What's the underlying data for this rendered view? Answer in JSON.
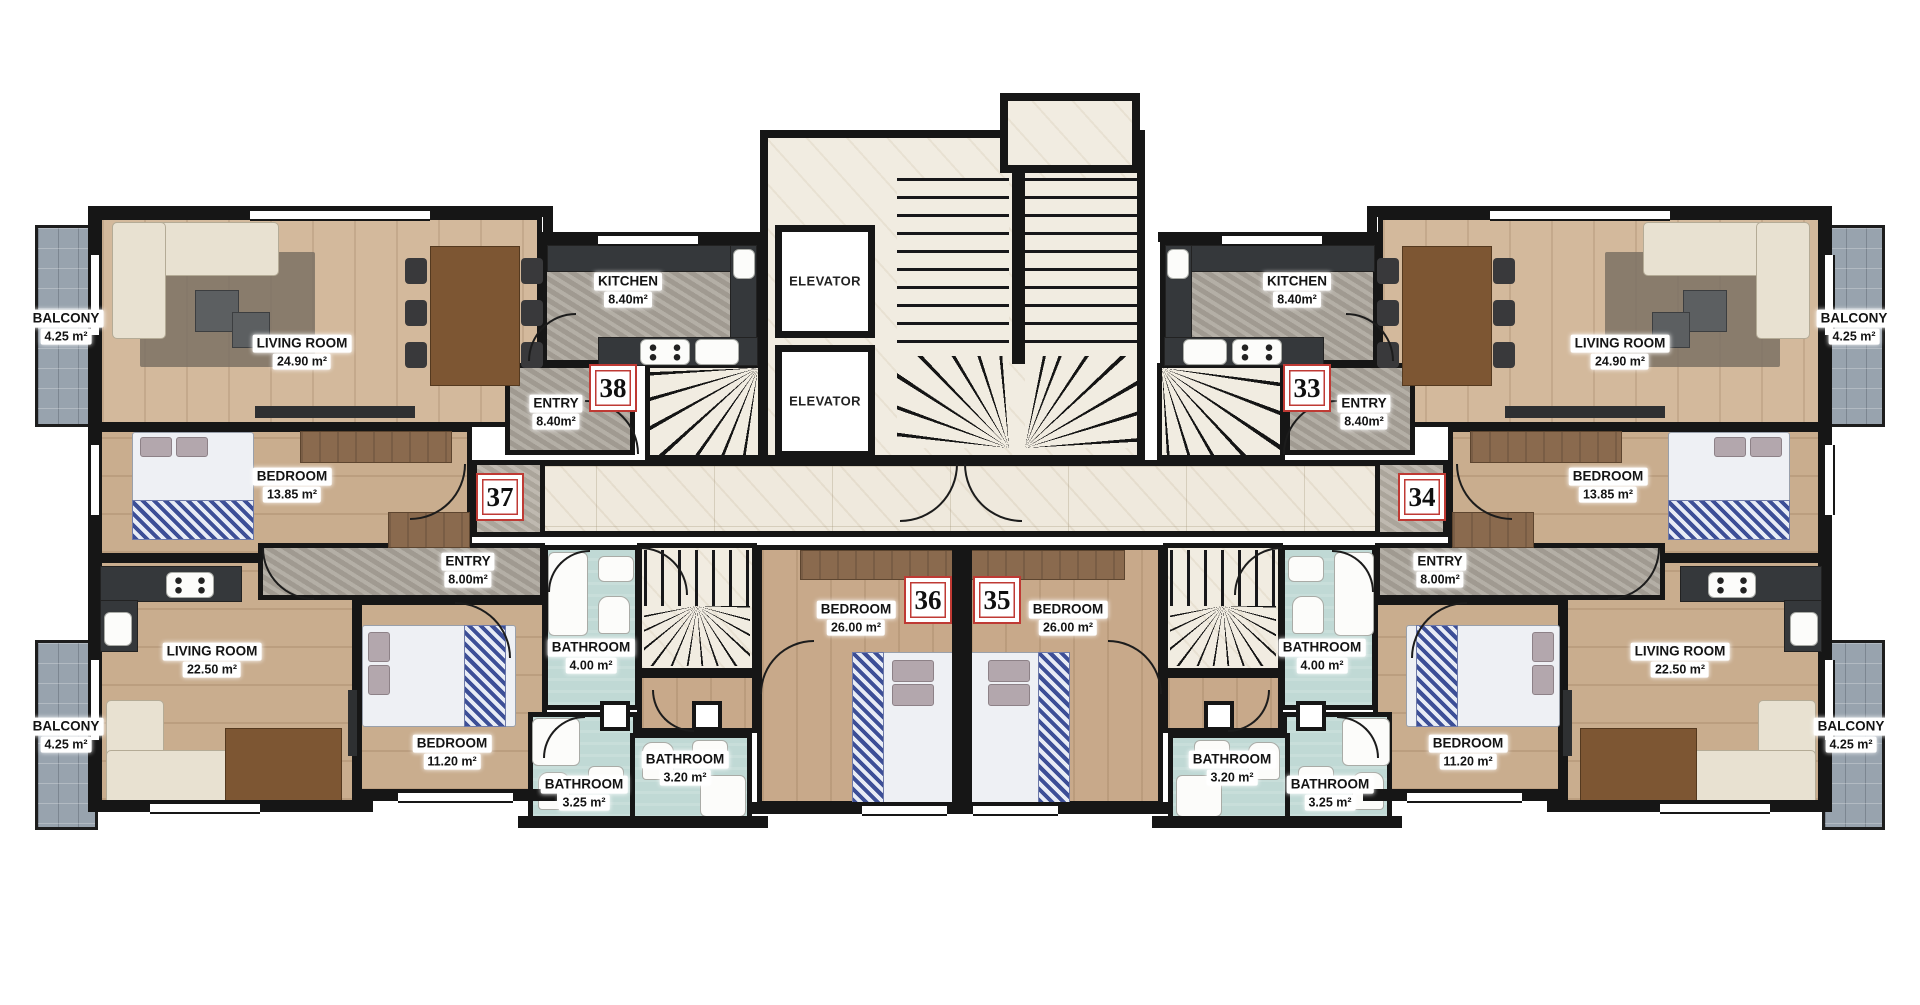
{
  "colors": {
    "wall": "#161616",
    "accent_red": "#bf3a34",
    "bath_floor": "#c0d9d5",
    "balcony_floor": "#98a3ae",
    "marble": "#f1ece1",
    "entry_stone": "#aca69c",
    "wood": "#d3b99c"
  },
  "units": {
    "u33": "33",
    "u34": "34",
    "u35": "35",
    "u36": "36",
    "u37": "37",
    "u38": "38"
  },
  "core": {
    "elevator_label": "ELEVATOR"
  },
  "rooms": {
    "balcony_tl": {
      "name": "BALCONY",
      "area": "4.25 m²"
    },
    "living_tl": {
      "name": "LIVING ROOM",
      "area": "24.90 m²"
    },
    "kitchen_left": {
      "name": "KITCHEN",
      "area": "8.40m²"
    },
    "entry_38": {
      "name": "ENTRY",
      "area": "8.40m²"
    },
    "bedroom_tl": {
      "name": "BEDROOM",
      "area": "13.85 m²"
    },
    "entry_37": {
      "name": "ENTRY",
      "area": "8.00m²"
    },
    "living_bl": {
      "name": "LIVING ROOM",
      "area": "22.50 m²"
    },
    "balcony_bl": {
      "name": "BALCONY",
      "area": "4.25 m²"
    },
    "bedroom_bl": {
      "name": "BEDROOM",
      "area": "11.20 m²"
    },
    "bathroom_l_400": {
      "name": "BATHROOM",
      "area": "4.00 m²"
    },
    "bathroom_l_325": {
      "name": "BATHROOM",
      "area": "3.25 m²"
    },
    "bathroom_36_320": {
      "name": "BATHROOM",
      "area": "3.20 m²"
    },
    "bedroom_36": {
      "name": "BEDROOM",
      "area": "26.00 m²"
    },
    "bedroom_35": {
      "name": "BEDROOM",
      "area": "26.00 m²"
    },
    "bathroom_35_320": {
      "name": "BATHROOM",
      "area": "3.20 m²"
    },
    "bathroom_r_400": {
      "name": "BATHROOM",
      "area": "4.00 m²"
    },
    "bathroom_r_325": {
      "name": "BATHROOM",
      "area": "3.25 m²"
    },
    "bedroom_br": {
      "name": "BEDROOM",
      "area": "11.20 m²"
    },
    "entry_34": {
      "name": "ENTRY",
      "area": "8.00m²"
    },
    "living_br": {
      "name": "LIVING ROOM",
      "area": "22.50 m²"
    },
    "balcony_br": {
      "name": "BALCONY",
      "area": "4.25 m²"
    },
    "bedroom_tr": {
      "name": "BEDROOM",
      "area": "13.85 m²"
    },
    "entry_33": {
      "name": "ENTRY",
      "area": "8.40m²"
    },
    "kitchen_right": {
      "name": "KITCHEN",
      "area": "8.40m²"
    },
    "living_tr": {
      "name": "LIVING ROOM",
      "area": "24.90 m²"
    },
    "balcony_tr": {
      "name": "BALCONY",
      "area": "4.25 m²"
    }
  }
}
